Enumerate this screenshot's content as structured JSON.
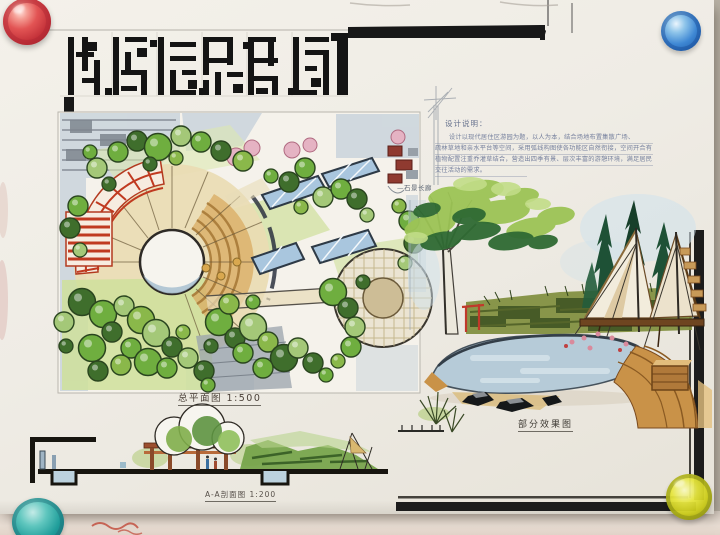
{
  "board": {
    "description": "Hand-drawn landscape architecture presentation board (marker and ink rendering) pinned to a wall",
    "title_lettering": "手绘块状美术字标题（笔画抽象）"
  },
  "labels": {
    "site_plan": "总平面图 1:500",
    "section": "A-A剖面图 1:200",
    "perspective": "部分效果图",
    "corridor_annotation": "—石景长廊"
  },
  "notes": {
    "heading": "设计说明：",
    "lines": [
      "设计以现代居住区游园为题，以人为本，结合场地布置集散广场、",
      "疏林草地和亲水平台等空间，采用弧线构图使各功能区自然衔接，空间开合有致，",
      "植物配置注重乔灌草结合，营造出四季有景、层次丰富的游憩环境，满足居民休闲、",
      "交往活动的需求。"
    ]
  },
  "pins": [
    {
      "position": "top-left",
      "color": "#d8474f"
    },
    {
      "position": "top-right",
      "color": "#3f87d4"
    },
    {
      "position": "bottom-right",
      "color": "#d8d428"
    },
    {
      "position": "bottom-left",
      "color": "#2f9fae"
    }
  ],
  "palette": {
    "paper": "#efece5",
    "ink": "#1a1a1a",
    "tree_green": "#6fae3f",
    "dark_green": "#3f6e2c",
    "water_blue": "#b6cbd8",
    "deck_tan": "#c99248",
    "pergola_red": "#c03a20",
    "glass_blue": "#a9c6de"
  }
}
